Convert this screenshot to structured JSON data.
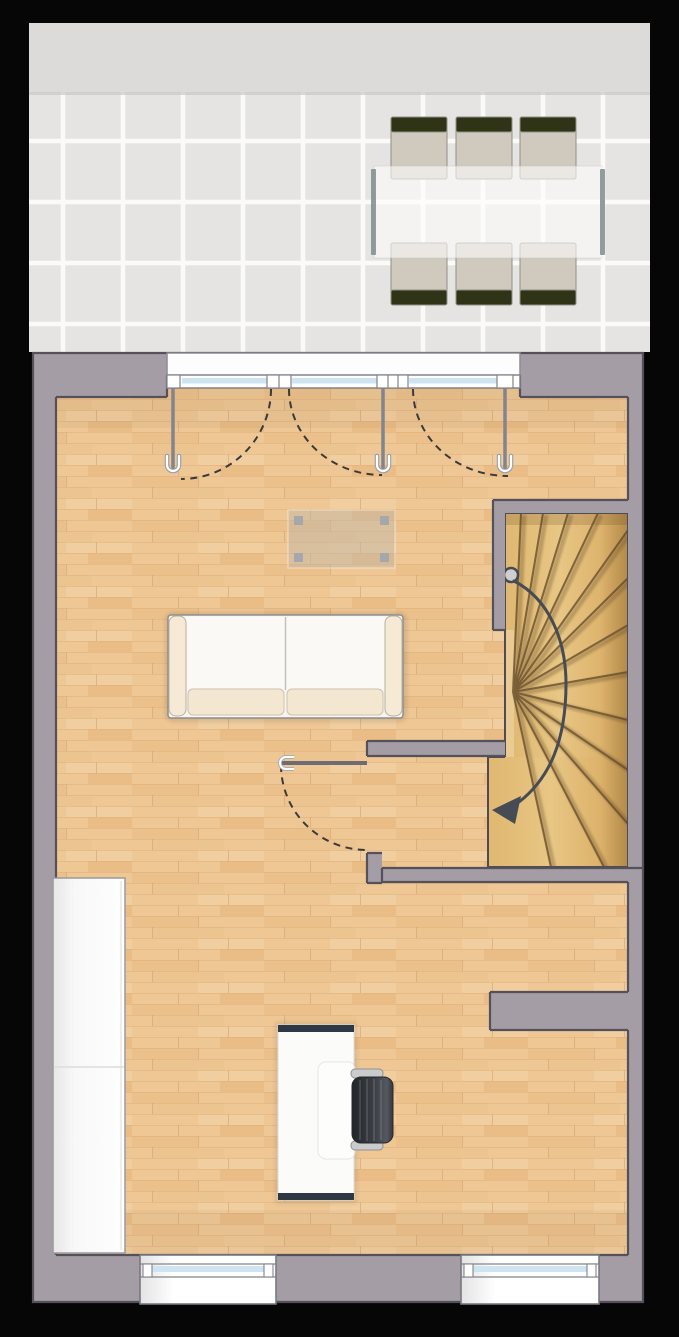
{
  "plan": {
    "type": "residential-floor-plan",
    "rooms": [
      {
        "name": "terrace",
        "floor": "ceramic-tile"
      },
      {
        "name": "living-area",
        "floor": "wood-parquet"
      },
      {
        "name": "stair-hall",
        "floor": "wood-parquet"
      }
    ],
    "furniture": {
      "terrace_dining_table": 1,
      "terrace_chairs": 6,
      "sofa": 1,
      "coffee_table": 1,
      "wardrobe": 1,
      "desk": 1,
      "office_chair": 1
    },
    "openings": {
      "patio_door_leaves": 3,
      "interior_doors": 1,
      "bottom_windows": 2,
      "staircase": {
        "kind": "winder",
        "direction_arrow": "up-from-bottom"
      }
    },
    "colors": {
      "background": "#060606",
      "wall": "#a49da6",
      "wallLine": "#55515a",
      "floorBase": "#eec795",
      "floorLine": "#d9ab74",
      "stairLight": "#e8c684",
      "stairDark": "#d6a75d",
      "treadLine": "#6e5531",
      "terraceBand": "#dcdbd9",
      "tile": "#e7e6e4",
      "grout": "#fafaf9",
      "glass": "#cfe4f1",
      "frameWhite": "#ffffff",
      "chairOlive": "#303416",
      "chairSeat": "#d0cabe",
      "tableEdge": "#7f8d8c",
      "sofaBody": "#f7f5f0",
      "sofaCushion": "#f4e7d2",
      "sofaArm": "#f6e9d6",
      "deskEdge": "#2c3845",
      "officeChairDark": "#2f3237",
      "arrow": "#464b54",
      "swingArc": "#3a3a3a",
      "windowWhite": "#fefefe"
    }
  }
}
